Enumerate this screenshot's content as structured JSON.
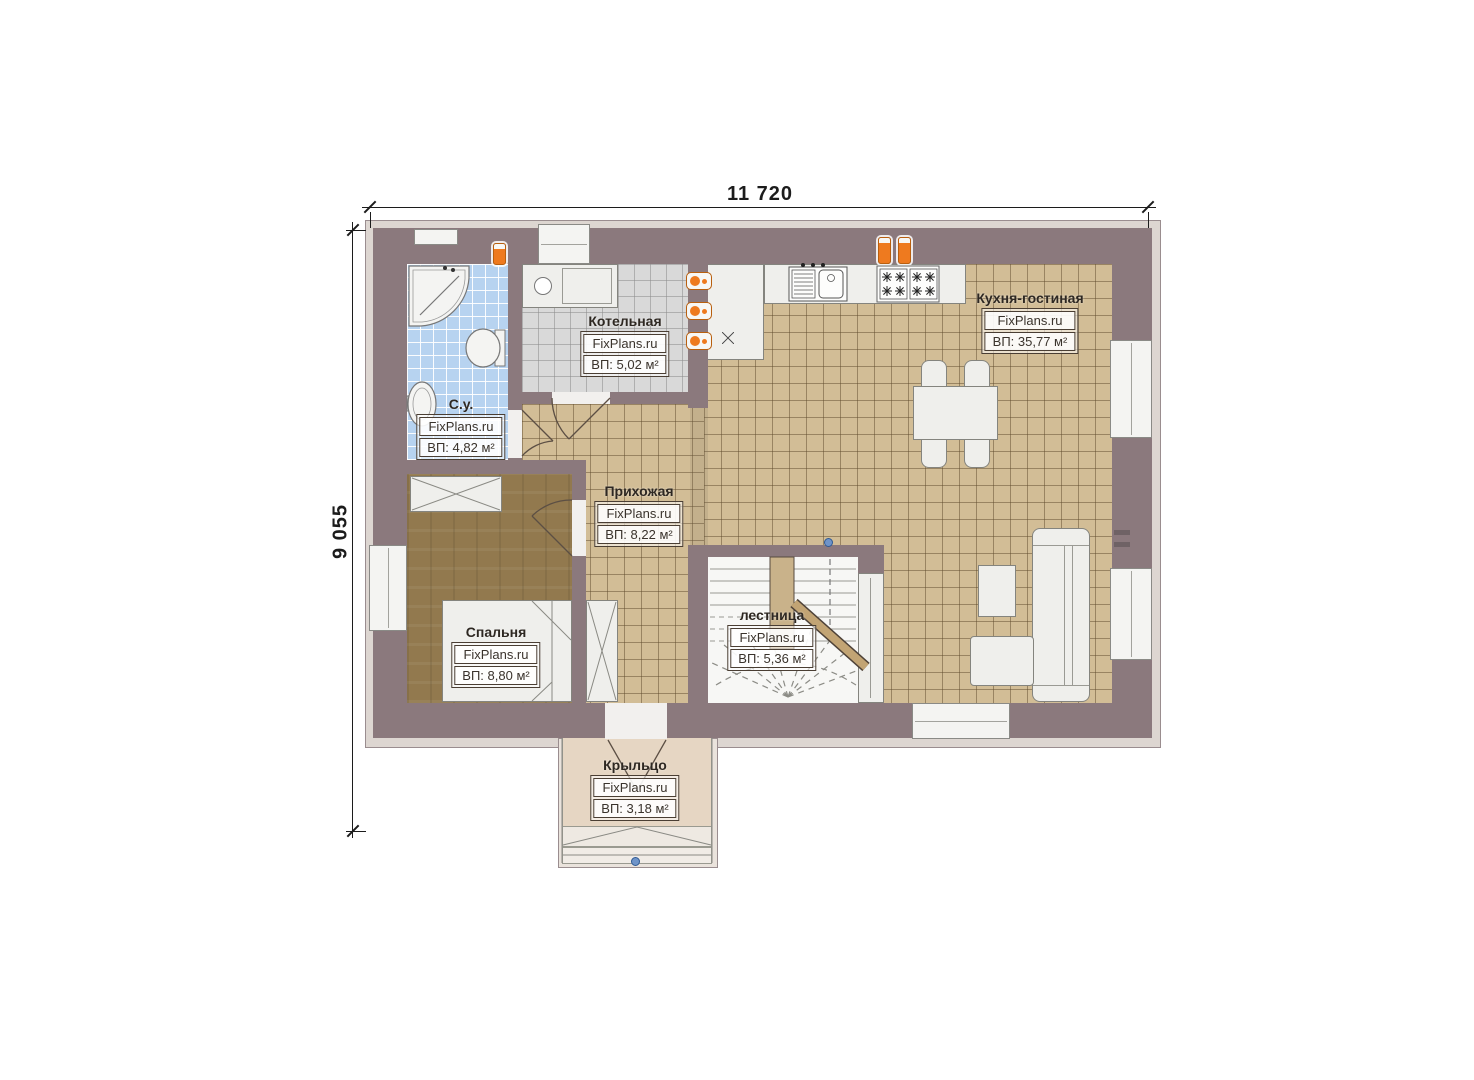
{
  "plan": {
    "type": "floor-plan",
    "watermark": "FixPlans.ru",
    "dimensions": {
      "top": "11 720",
      "left": "9 055"
    },
    "rooms": [
      {
        "name": "С.у.",
        "site": "FixPlans.ru",
        "area": "ВП: 4,82 м²"
      },
      {
        "name": "Котельная",
        "site": "FixPlans.ru",
        "area": "ВП: 5,02 м²"
      },
      {
        "name": "Кухня-гостиная",
        "site": "FixPlans.ru",
        "area": "ВП: 35,77 м²"
      },
      {
        "name": "Прихожая",
        "site": "FixPlans.ru",
        "area": "ВП: 8,22 м²"
      },
      {
        "name": "Спальня",
        "site": "FixPlans.ru",
        "area": "ВП: 8,80 м²"
      },
      {
        "name": "лестница",
        "site": "FixPlans.ru",
        "area": "ВП: 5,36 м²"
      },
      {
        "name": "Крыльцо",
        "site": "FixPlans.ru",
        "area": "ВП: 3,18 м²"
      }
    ],
    "colors": {
      "wall": "#8b797d",
      "kitchen_floor": "#d2bd96",
      "bath_floor": "#b7d3f0",
      "boiler_floor": "#d9d9d9",
      "bedroom_floor": "#92794e",
      "porch_floor": "#e6d6c3",
      "radiator": "#ee7a1f"
    }
  }
}
